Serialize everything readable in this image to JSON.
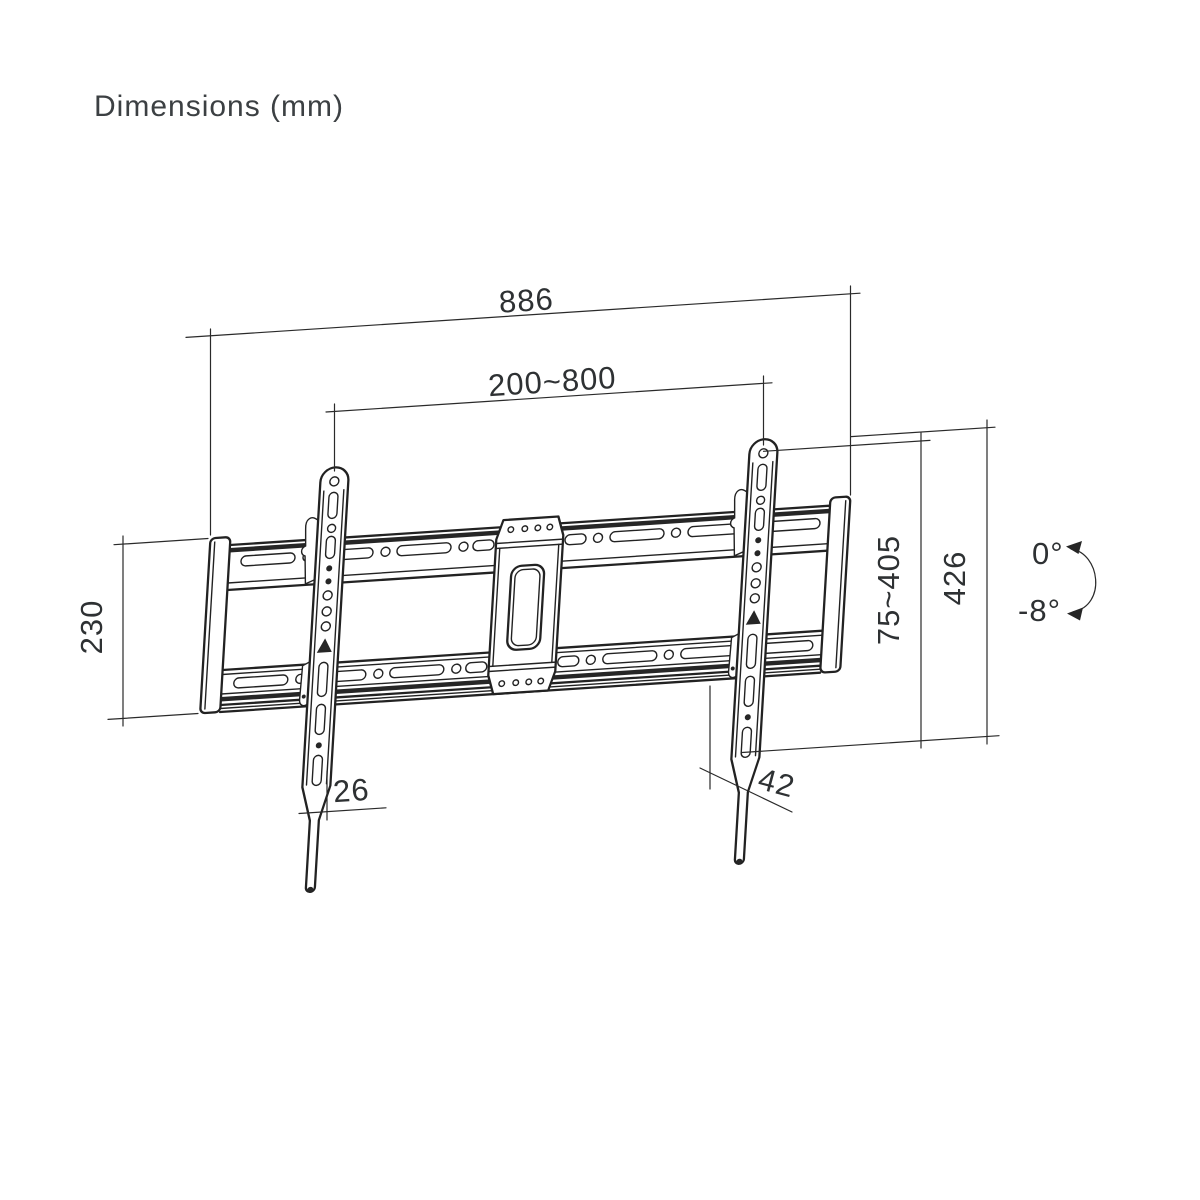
{
  "title": "Dimensions (mm)",
  "figure": {
    "type": "technical-drawing",
    "subject": "tilting TV wall mount bracket",
    "units": "mm"
  },
  "dimensions": {
    "overall_width": "886",
    "mounting_width_range": "200~800",
    "wall_plate_height": "230",
    "bracket_height_range": "75~405",
    "overall_height": "426",
    "strap_width": "26",
    "depth_offset": "42"
  },
  "tilt": {
    "max": "0°",
    "min": "-8°"
  },
  "colors": {
    "line": "#222222",
    "text": "#3c4043",
    "background": "#ffffff"
  }
}
